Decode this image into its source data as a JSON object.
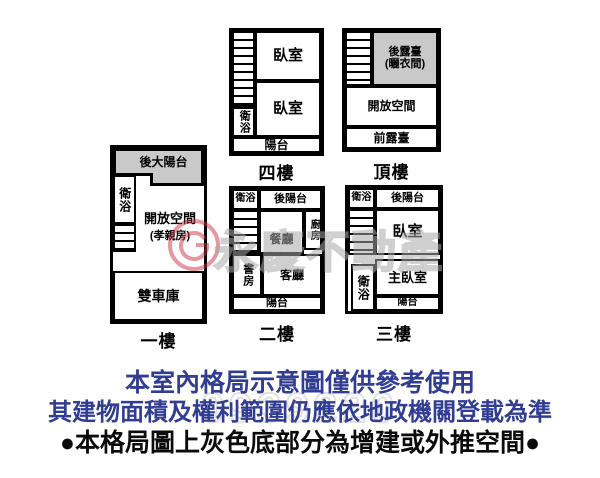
{
  "colors": {
    "wall": "#000000",
    "gray_fill": "#c9c9c9",
    "note_blue": "#313d92",
    "watermark_gray": "#a8a8a8",
    "watermark_red": "#cc3344"
  },
  "floors": {
    "f1": {
      "label": "一樓",
      "rooms": {
        "back_big_balcony": "後大陽台",
        "bath": "衛浴",
        "open_space": "開放空間",
        "open_space_sub": "(孝親房)",
        "garage": "雙車庫"
      }
    },
    "f2": {
      "label": "二樓",
      "rooms": {
        "bath": "衛浴",
        "back_balcony": "後陽台",
        "kitchen": "廚房",
        "dining": "餐廳",
        "study": "書房",
        "living": "客廳",
        "balcony": "陽台"
      }
    },
    "f3": {
      "label": "三樓",
      "rooms": {
        "bath_top": "衛浴",
        "back_balcony": "後陽台",
        "bedroom": "臥室",
        "bath_lower": "衛浴",
        "master_bedroom": "主臥室",
        "balcony": "陽台"
      }
    },
    "f4": {
      "label": "四樓",
      "rooms": {
        "bedroom1": "臥室",
        "bedroom2": "臥室",
        "bath": "衛浴",
        "balcony": "陽台"
      }
    },
    "roof": {
      "label": "頂樓",
      "rooms": {
        "back_terrace": "後露臺",
        "back_terrace_sub": "(曬衣間)",
        "open_space": "開放空間",
        "front_terrace": "前露臺"
      }
    }
  },
  "watermark": {
    "brand": "永慶不動產",
    "digits": "0939220"
  },
  "notes": {
    "line1": "本室內格局示意圖僅供參考使用",
    "line2": "其建物面積及權利範圍仍應依地政機關登載為準",
    "line3": "●本格局圖上灰色底部分為增建或外推空間●"
  }
}
